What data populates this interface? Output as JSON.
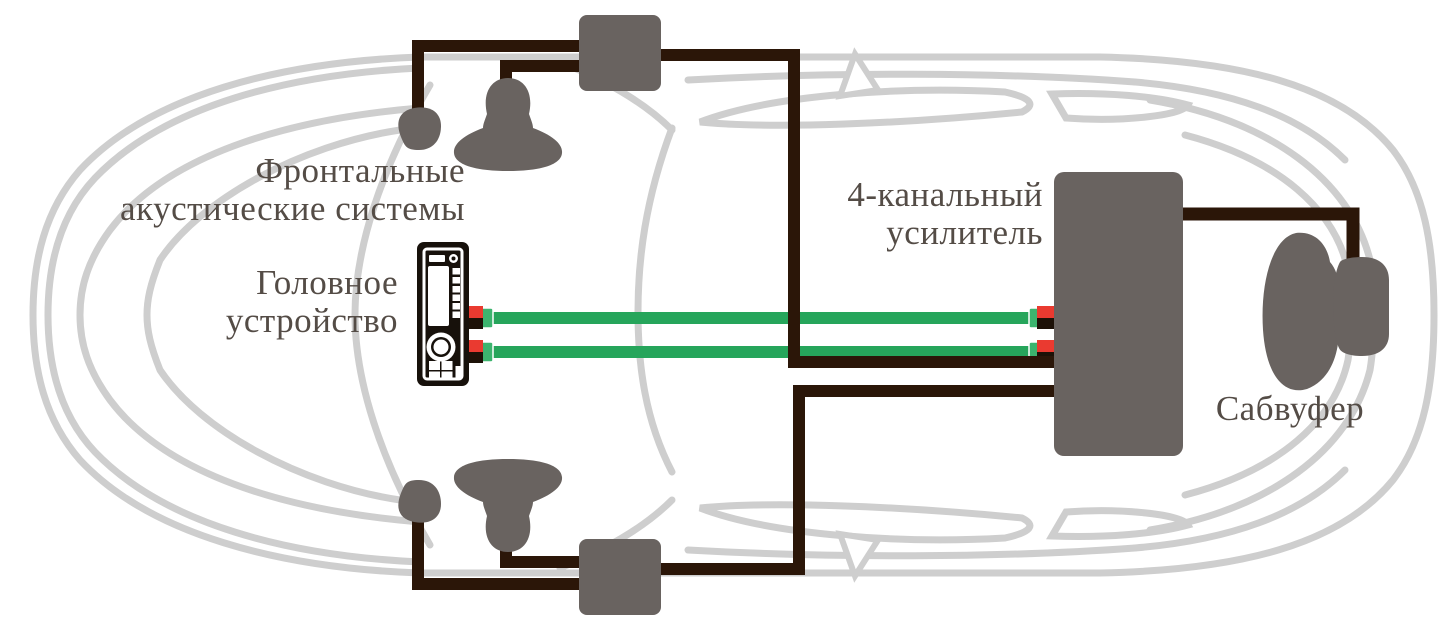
{
  "labels": {
    "front_speakers": {
      "line1": "Фронтальные",
      "line2": "акустические системы"
    },
    "head_unit": {
      "line1": "Головное",
      "line2": "устройство"
    },
    "amplifier": {
      "line1": "4-канальный",
      "line2": "усилитель"
    },
    "subwoofer": {
      "line1": "Сабвуфер"
    }
  },
  "icons": [
    "head-unit-icon",
    "tweeter-icon",
    "midrange-speaker-icon",
    "crossover-icon",
    "amplifier-icon",
    "subwoofer-icon",
    "rca-cable",
    "rca-plug-red",
    "rca-plug-black",
    "speaker-wire",
    "car-outline"
  ],
  "colors": {
    "background": "#ffffff",
    "car-line": "#cecece",
    "wire": "#2b1608",
    "cable-green": "#26a55b",
    "connector-green": "#3cb46e",
    "plug-red": "#ea3a30",
    "plug-black": "#1d1107",
    "component-gray": "#696360",
    "unit-black": "#17110b",
    "text": "#544c46"
  }
}
